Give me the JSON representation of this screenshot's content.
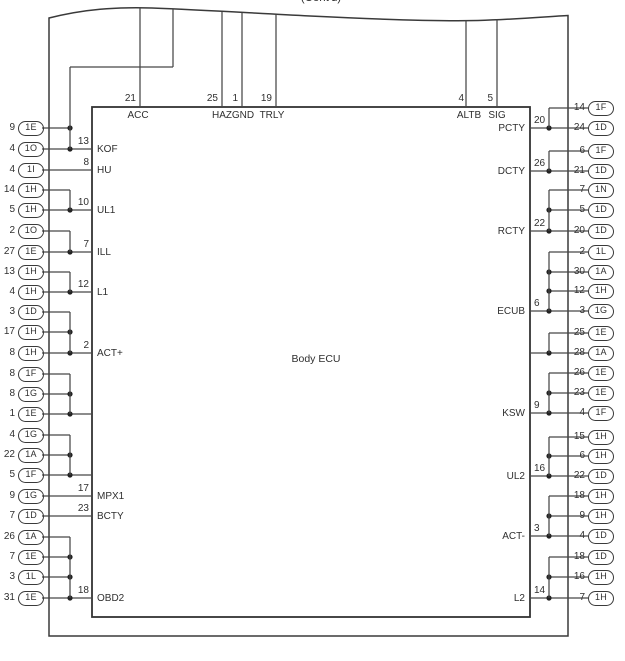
{
  "page": {
    "continued_label": "(Cont'd)"
  },
  "colors": {
    "ink": "#3a3a3a",
    "wire": "#474747",
    "background": "#ffffff"
  },
  "ecu": {
    "title": "Body ECU"
  },
  "top_pins": [
    {
      "pin_no": "21",
      "pin_name": "ACC"
    },
    {
      "pin_no": "25",
      "pin_name": "HAZ"
    },
    {
      "pin_no": "1",
      "pin_name": "GND"
    },
    {
      "pin_no": "19",
      "pin_name": "TRLY"
    },
    {
      "pin_no": "4",
      "pin_name": "ALTB"
    },
    {
      "pin_no": "5",
      "pin_name": "SIG"
    }
  ],
  "left": {
    "groups": [
      {
        "pin_no": "13",
        "pin_name": "KOF",
        "connectors": [
          {
            "no": "9",
            "code": "1E"
          },
          {
            "no": "4",
            "code": "1O"
          }
        ]
      },
      {
        "pin_no": "8",
        "pin_name": "HU",
        "connectors": [
          {
            "no": "4",
            "code": "1I"
          }
        ]
      },
      {
        "pin_no": "10",
        "pin_name": "UL1",
        "connectors": [
          {
            "no": "14",
            "code": "1H"
          },
          {
            "no": "5",
            "code": "1H"
          }
        ]
      },
      {
        "pin_no": "7",
        "pin_name": "ILL",
        "connectors": [
          {
            "no": "2",
            "code": "1O"
          },
          {
            "no": "27",
            "code": "1E"
          }
        ]
      },
      {
        "pin_no": "12",
        "pin_name": "L1",
        "connectors": [
          {
            "no": "13",
            "code": "1H"
          },
          {
            "no": "4",
            "code": "1H"
          }
        ]
      },
      {
        "pin_no": "2",
        "pin_name": "ACT+",
        "connectors": [
          {
            "no": "3",
            "code": "1D"
          },
          {
            "no": "17",
            "code": "1H"
          },
          {
            "no": "8",
            "code": "1H"
          }
        ]
      },
      {
        "pin_no": "",
        "pin_name": "",
        "connectors": [
          {
            "no": "8",
            "code": "1F"
          },
          {
            "no": "8",
            "code": "1G"
          },
          {
            "no": "1",
            "code": "1E"
          }
        ]
      },
      {
        "pin_no": "",
        "pin_name": "",
        "connectors": [
          {
            "no": "4",
            "code": "1G"
          },
          {
            "no": "22",
            "code": "1A"
          },
          {
            "no": "5",
            "code": "1F"
          }
        ]
      },
      {
        "pin_no": "17",
        "pin_name": "MPX1",
        "connectors": [
          {
            "no": "9",
            "code": "1G"
          }
        ]
      },
      {
        "pin_no": "23",
        "pin_name": "BCTY",
        "connectors": [
          {
            "no": "7",
            "code": "1D"
          }
        ]
      },
      {
        "pin_no": "18",
        "pin_name": "OBD2",
        "connectors": [
          {
            "no": "26",
            "code": "1A"
          },
          {
            "no": "7",
            "code": "1E"
          },
          {
            "no": "3",
            "code": "1L"
          },
          {
            "no": "31",
            "code": "1E"
          }
        ]
      }
    ]
  },
  "right": {
    "groups": [
      {
        "pin_no": "20",
        "pin_name": "PCTY",
        "connectors": [
          {
            "no": "14",
            "code": "1F"
          },
          {
            "no": "24",
            "code": "1D"
          }
        ]
      },
      {
        "pin_no": "26",
        "pin_name": "DCTY",
        "connectors": [
          {
            "no": "6",
            "code": "1F"
          },
          {
            "no": "21",
            "code": "1D"
          }
        ]
      },
      {
        "pin_no": "22",
        "pin_name": "RCTY",
        "connectors": [
          {
            "no": "7",
            "code": "1N"
          },
          {
            "no": "5",
            "code": "1D"
          },
          {
            "no": "20",
            "code": "1D"
          }
        ]
      },
      {
        "pin_no": "6",
        "pin_name": "ECUB",
        "connectors": [
          {
            "no": "2",
            "code": "1L"
          },
          {
            "no": "30",
            "code": "1A"
          },
          {
            "no": "12",
            "code": "1H"
          },
          {
            "no": "3",
            "code": "1G"
          }
        ]
      },
      {
        "pin_no": "",
        "pin_name": "",
        "connectors": [
          {
            "no": "25",
            "code": "1E"
          },
          {
            "no": "28",
            "code": "1A"
          }
        ]
      },
      {
        "pin_no": "9",
        "pin_name": "KSW",
        "connectors": [
          {
            "no": "26",
            "code": "1E"
          },
          {
            "no": "23",
            "code": "1E"
          },
          {
            "no": "4",
            "code": "1F"
          }
        ]
      },
      {
        "pin_no": "16",
        "pin_name": "UL2",
        "connectors": [
          {
            "no": "15",
            "code": "1H"
          },
          {
            "no": "6",
            "code": "1H"
          },
          {
            "no": "22",
            "code": "1D"
          }
        ]
      },
      {
        "pin_no": "3",
        "pin_name": "ACT-",
        "connectors": [
          {
            "no": "18",
            "code": "1H"
          },
          {
            "no": "9",
            "code": "1H"
          },
          {
            "no": "4",
            "code": "1D"
          }
        ]
      },
      {
        "pin_no": "14",
        "pin_name": "L2",
        "connectors": [
          {
            "no": "18",
            "code": "1D"
          },
          {
            "no": "16",
            "code": "1H"
          },
          {
            "no": "7",
            "code": "1H"
          }
        ]
      }
    ]
  }
}
